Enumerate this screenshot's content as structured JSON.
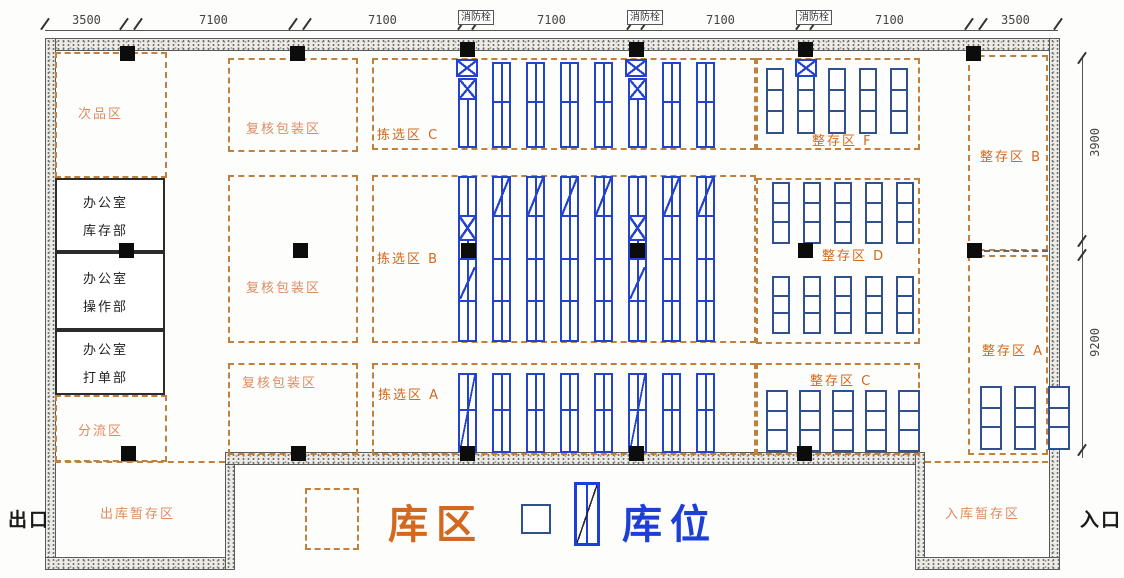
{
  "dims": {
    "top": [
      "3500",
      "7100",
      "7100",
      "7100",
      "7100",
      "7100",
      "3500"
    ],
    "right": [
      "3900",
      "9200"
    ]
  },
  "labels": {
    "hydrant": "消防栓",
    "defective": "次品区",
    "office": "办公室",
    "dept_inventory": "库存部",
    "dept_operation": "操作部",
    "dept_billing": "打单部",
    "sorting": "分流区",
    "repack": "复核包装区",
    "pick_c": "拣选区 C",
    "pick_b": "拣选区 B",
    "pick_a": "拣选区 A",
    "bulk_f": "整存区 F",
    "bulk_b": "整存区 B",
    "bulk_d": "整存区 D",
    "bulk_a": "整存区 A",
    "bulk_c": "整存区 C",
    "outbound": "出库暂存区",
    "inbound": "入库暂存区"
  },
  "gates": {
    "exit": "出口",
    "entrance": "入口"
  },
  "legend": {
    "zone": "库区",
    "slot": "库位"
  },
  "colors": {
    "zone_border": "#c08040",
    "zone_text": "#d2691e",
    "zone_text_soft": "#de8a62",
    "rack_blue": "#2343cc",
    "pallet_navy": "#31508f",
    "legend_slot_blue": "#1d3fd6",
    "wall_gray": "#ecebe6"
  }
}
